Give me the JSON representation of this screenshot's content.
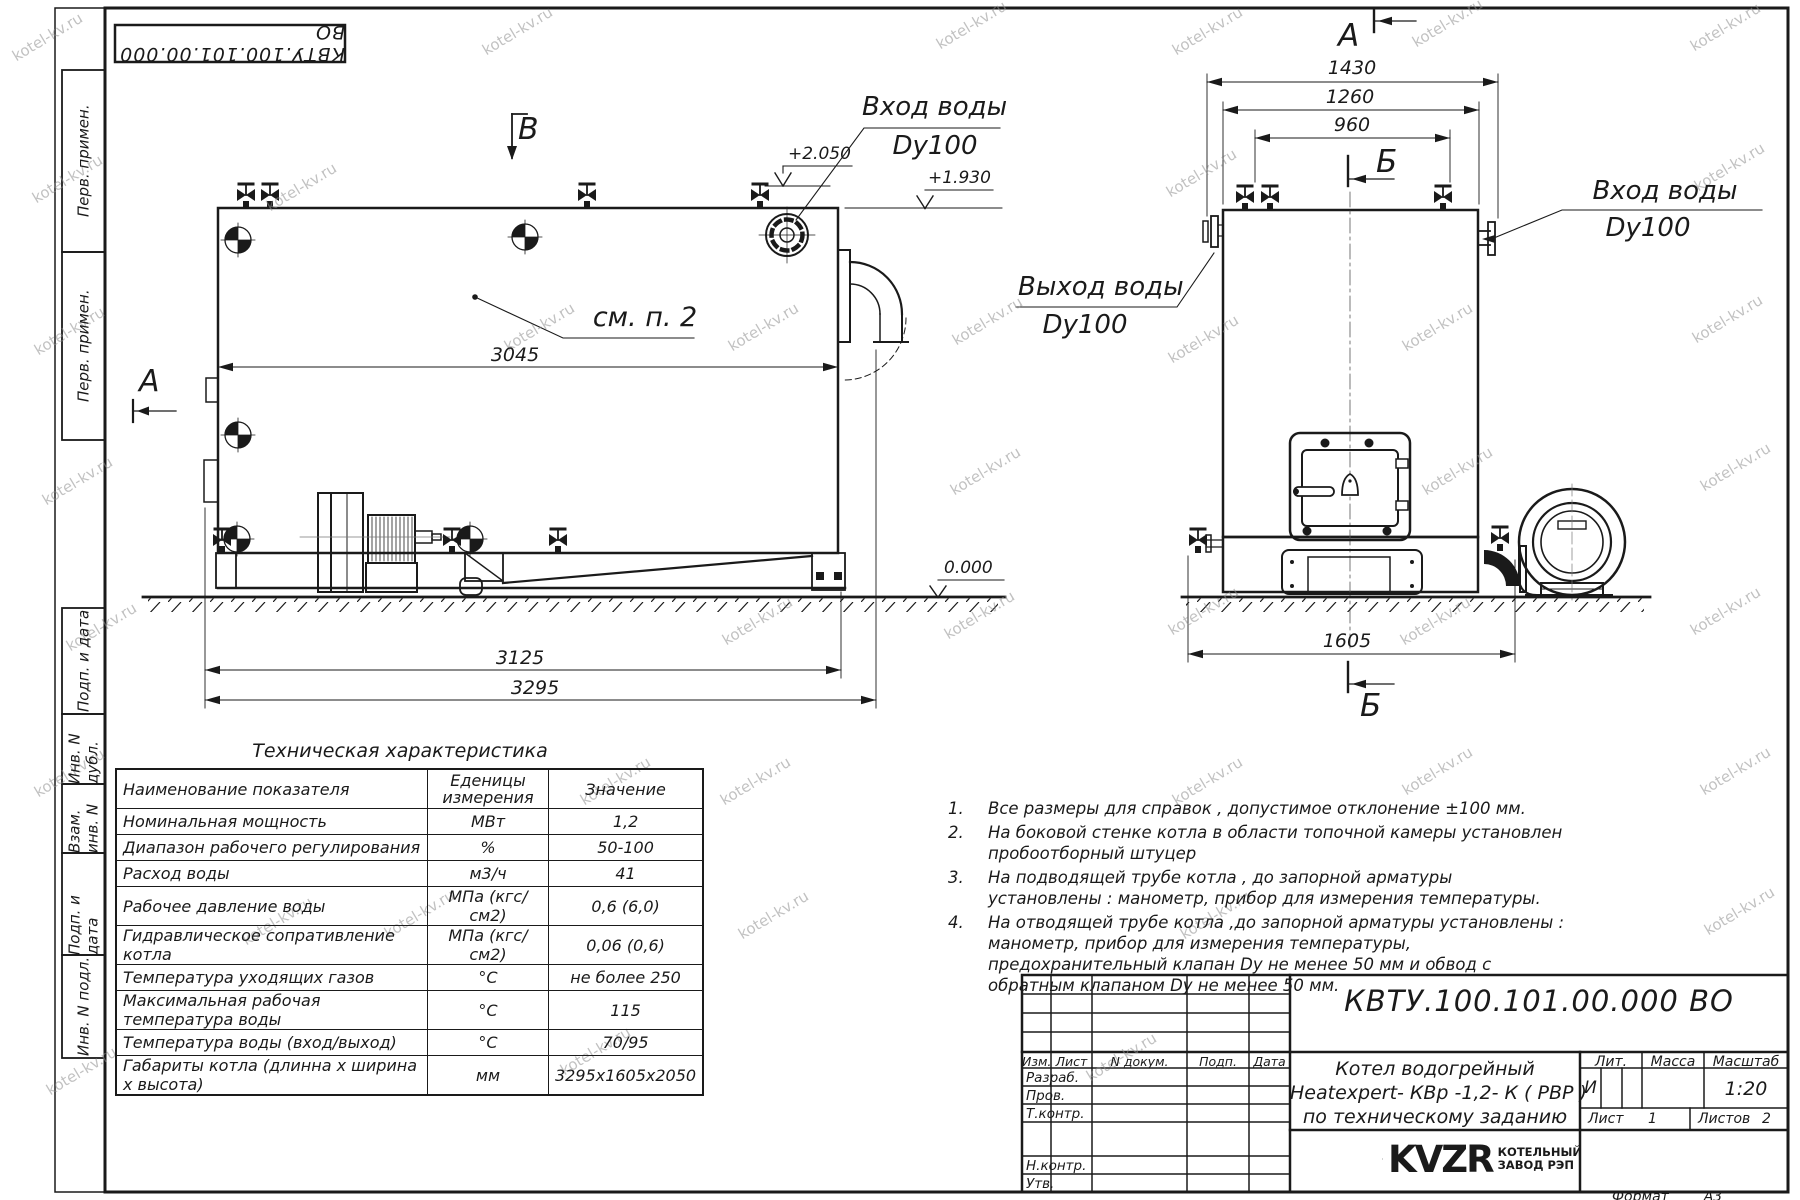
{
  "watermark": {
    "text": "kotel-kv.ru"
  },
  "margin_labels": [
    "Перв. примен.",
    "Перв. примен.",
    "Подп. и дата",
    "Инв. N дубл.",
    "Взам. инв. N",
    "Подп. и дата",
    "Инв. N подл."
  ],
  "side_view": {
    "view_label_top": "В",
    "view_label_side": "А",
    "inlet_callout_line1": "Вход воды",
    "inlet_callout_line2": "Dy100",
    "elev_top": "+2.050",
    "elev_mid": "+1.930",
    "elev_zero": "0.000",
    "see_note": "см. п. 2",
    "dim_body": "3045",
    "dim_base": "3125",
    "dim_overall": "3295"
  },
  "front_view": {
    "view_label": "А",
    "section_label_top": "Б",
    "section_label_bottom": "Б",
    "dim_flanges": "1430",
    "dim_body": "1260",
    "dim_valves": "960",
    "dim_base": "1605",
    "outlet_callout_line1": "Выход воды",
    "outlet_callout_line2": "Dy100",
    "inlet_callout_line1": "Вход воды",
    "inlet_callout_line2": "Dy100"
  },
  "notes": [
    {
      "num": "1.",
      "text": "Все размеры для справок , допустимое отклонение  ±100 мм."
    },
    {
      "num": "2.",
      "text": "На боковой стенке котла в области топочной камеры установлен пробоотборный штуцер"
    },
    {
      "num": "3.",
      "text": "На  подводящей трубе котла , до запорной арматуры установлены : манометр, прибор для измерения температуры."
    },
    {
      "num": "4.",
      "text": "На отводящей трубе котла ,до запорной арматуры установлены : манометр, прибор для измерения температуры, предохранительный клапан  Dу не менее  50 мм и обвод с обратным клапаном  Dу не менее  50 мм."
    }
  ],
  "table": {
    "title": "Техническая характеристика",
    "headers": [
      "Наименование показателя",
      "Еденицы\nизмерения",
      "Значение"
    ],
    "rows": [
      [
        "Номинальная мощность",
        "МВт",
        "1,2"
      ],
      [
        "Диапазон рабочего регулирования",
        "%",
        "50-100"
      ],
      [
        "Расход воды",
        "м3/ч",
        "41"
      ],
      [
        "Рабочее давление воды",
        "МПа (кгс/см2)",
        "0,6 (6,0)"
      ],
      [
        "Гидравлическое сопративление котла",
        "МПа (кгс/см2)",
        "0,06 (0,6)"
      ],
      [
        "Температура уходящих газов",
        "°С",
        "не более 250"
      ],
      [
        "Максимальная рабочая температура воды",
        "°С",
        "115"
      ],
      [
        "Температура воды (вход/выход)",
        "°С",
        "70/95"
      ],
      [
        "Габариты котла (длинна х ширина х высота)",
        "мм",
        "3295х1605х2050"
      ]
    ]
  },
  "title_block": {
    "doc_number": "КВТУ.100.101.00.000  ВО",
    "name_line1": "Котел водогрейный",
    "name_line2": "Heatexpert- КВр -1,2- К ( РВР )",
    "name_line3": "по техническому заданию",
    "header_cols": [
      "Изм.",
      "Лист",
      "N докум.",
      "Подп.",
      "Дата"
    ],
    "row_labels": [
      "Разраб.",
      "Пров.",
      "Т.контр.",
      "Н.контр.",
      "Утв."
    ],
    "lit_label": "Лит.",
    "mass_label": "Масса",
    "scale_label": "Масштаб",
    "lit_value": "И",
    "scale_value": "1:20",
    "sheet_label": "Лист",
    "sheet_value": "1",
    "sheets_label": "Листов",
    "sheets_value": "2",
    "company_logo": "KVZR",
    "company_line1": "КОТЕЛЬНЫЙ",
    "company_line2": "ЗАВОД РЭП",
    "format_label": "Формат",
    "format_value": "А3"
  }
}
